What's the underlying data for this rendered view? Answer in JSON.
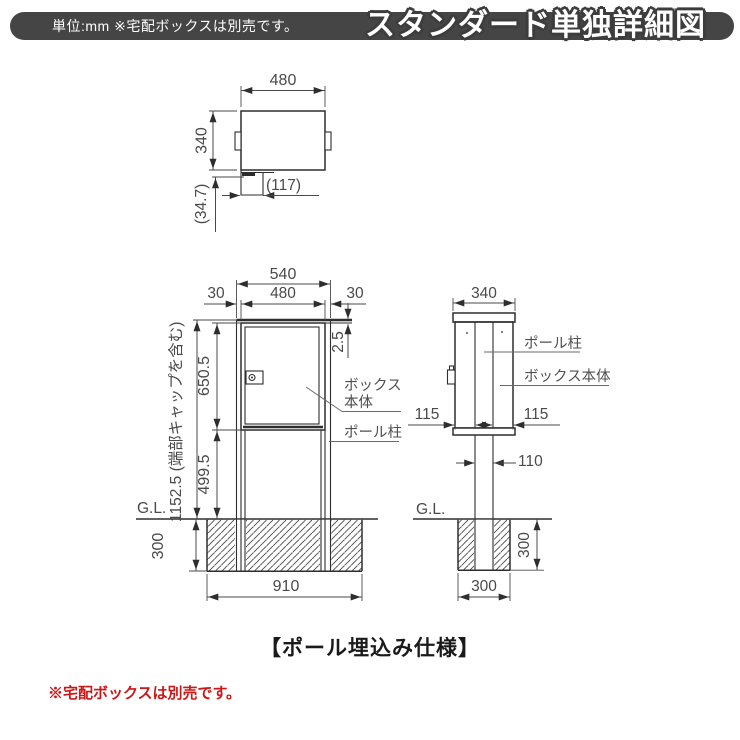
{
  "header": {
    "unit_note": "単位:mm ※宅配ボックスは別売です。",
    "title": "スタンダード単独詳細図"
  },
  "top_view": {
    "width": "480",
    "depth": "340",
    "latch_width": "(117)",
    "latch_depth": "(34.7)"
  },
  "front_view": {
    "total_width": "540",
    "overhang_left": "30",
    "box_width": "480",
    "overhang_right": "30",
    "cap_gap": "2.5",
    "box_height": "650.5",
    "ground_clearance": "499.5",
    "total_height_note": "1152.5 (端部キャップを含む)",
    "label_box_line1": "ボックス",
    "label_box_line2": "本体",
    "label_pole": "ポール柱",
    "gl_label": "G.L.",
    "embed_depth": "300",
    "footing_width": "910"
  },
  "side_view": {
    "depth": "340",
    "label_pole": "ポール柱",
    "label_box": "ボックス本体",
    "front_offset": "115",
    "rear_offset": "115",
    "pole_depth": "110",
    "gl_label": "G.L.",
    "embed_depth": "300",
    "footing_width": "300"
  },
  "caption": "【ポール埋込み仕様】",
  "note": "※宅配ボックスは別売です。",
  "colors": {
    "header_bg": "#454545",
    "line": "#2e2e2e",
    "dim_text": "#4a4a4a",
    "note_red": "#cd1616",
    "background": "#ffffff"
  }
}
